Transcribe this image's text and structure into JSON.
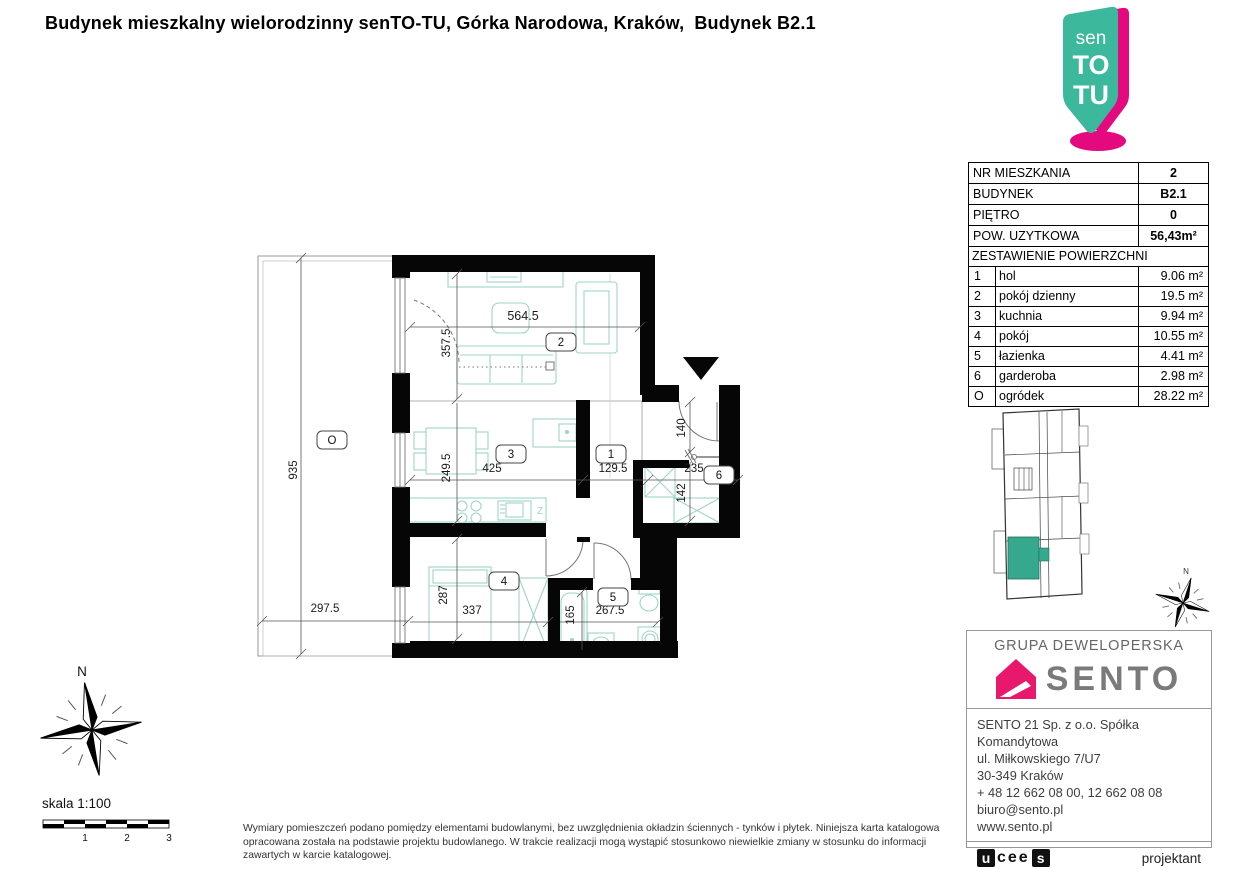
{
  "title": {
    "main": "Budynek mieszkalny wielorodzinny senTO-TU, Górka Narodowa, Kraków,",
    "suffix": "Budynek B2.1"
  },
  "logo_pin": {
    "line1": "sen",
    "line2": "TO",
    "line3": "TU",
    "teal": "#3CB89C",
    "magenta": "#E4097F"
  },
  "info_table": {
    "rows_top": [
      {
        "label": "NR MIESZKANIA",
        "value": "2"
      },
      {
        "label": "BUDYNEK",
        "value": "B2.1"
      },
      {
        "label": "PIĘTRO",
        "value": "0"
      },
      {
        "label": "POW. UZYTKOWA",
        "value": "56,43m²"
      }
    ],
    "section_header": "ZESTAWIENIE POWIERZCHNI",
    "rooms": [
      {
        "no": "1",
        "name": "hol",
        "area": "9.06 m²"
      },
      {
        "no": "2",
        "name": "pokój dzienny",
        "area": "19.5 m²"
      },
      {
        "no": "3",
        "name": "kuchnia",
        "area": "9.94 m²"
      },
      {
        "no": "4",
        "name": "pokój",
        "area": "10.55 m²"
      },
      {
        "no": "5",
        "name": "łazienka",
        "area": "4.41 m²"
      },
      {
        "no": "6",
        "name": "garderoba",
        "area": "2.98 m²"
      },
      {
        "no": "O",
        "name": "ogródek",
        "area": "28.22 m²"
      }
    ]
  },
  "plan": {
    "labels": {
      "garden": "O",
      "hall": "1",
      "living": "2",
      "kitchen": "3",
      "bedroom": "4",
      "bathroom": "5",
      "wardrobe": "6"
    },
    "dims": {
      "garden_h": "935",
      "garden_w": "297.5",
      "living_w": "564.5",
      "living_h": "357.5",
      "kitchen_w": "425",
      "kitchen_h": "249.5",
      "hall_w": "129.5",
      "entry_h": "140",
      "wardrobe_w": "235",
      "wardrobe_h": "142",
      "bedroom_h": "287",
      "bedroom_w": "337",
      "bath_h": "165",
      "bath_w": "267.5"
    },
    "sink_mark": "Z",
    "furniture_color": "#9ED4C6",
    "highlight_color": "#36A88D"
  },
  "compass": {
    "north": "N"
  },
  "site_compass": {
    "north": "N"
  },
  "scale_bar": {
    "label": "skala 1:100",
    "ticks": [
      "1",
      "2",
      "3"
    ]
  },
  "disclaimer": "Wymiary pomieszczeń podano pomiędzy elementami budowlanymi, bez uwzględnienia okładzin ściennych - tynków i płytek. Niniejsza karta katalogowa opracowana została na podstawie projektu budowlanego. W trakcie realizacji mogą wystąpić stosunkowo niewielkie zmiany w stosunku do informacji zawartych w karcie katalogowej.",
  "developer": {
    "group_label": "GRUPA DEWELOPERSKA",
    "brand": "SENTO",
    "address_lines": [
      "SENTO 21 Sp. z o.o. Spółka Komandytowa",
      "ul. Miłkowskiego 7/U7",
      "30-349 Kraków",
      "+ 48 12 662 08 00, 12 662 08 08",
      "biuro@sento.pl",
      "www.sento.pl"
    ],
    "designer_logo": {
      "u": "u",
      "cee": "cee",
      "s": "s"
    },
    "designer_label": "projektant"
  }
}
